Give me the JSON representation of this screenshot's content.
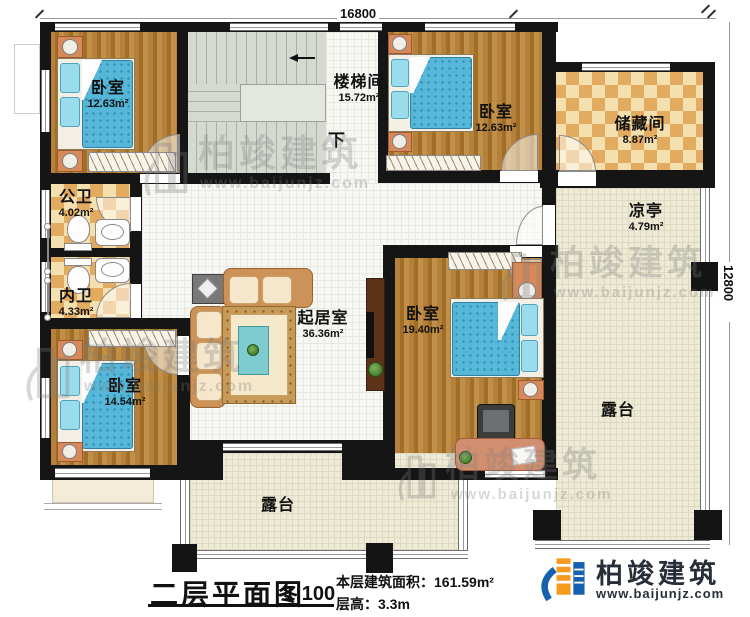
{
  "plan": {
    "title": "二层平面图",
    "scale": "1:100",
    "floor_area_label": "本层建筑面积：161.59m²",
    "floor_height_label": "层高：3.3m",
    "stairs_direction": "下",
    "dimensions": {
      "top": "16800",
      "right": "12800"
    }
  },
  "rooms": [
    {
      "id": "bedroom-top-left",
      "name": "卧室",
      "area": "12.63m²"
    },
    {
      "id": "stairwell",
      "name": "楼梯间",
      "area": "15.72m²"
    },
    {
      "id": "bedroom-top-right",
      "name": "卧室",
      "area": "12.63m²"
    },
    {
      "id": "storage",
      "name": "储藏间",
      "area": "8.87m²"
    },
    {
      "id": "pavilion",
      "name": "凉亭",
      "area": "4.79m²"
    },
    {
      "id": "public-bathroom",
      "name": "公卫",
      "area": "4.02m²"
    },
    {
      "id": "private-bathroom",
      "name": "内卫",
      "area": "4.33m²"
    },
    {
      "id": "living-room",
      "name": "起居室",
      "area": "36.36m²"
    },
    {
      "id": "bedroom-right",
      "name": "卧室",
      "area": "19.40m²"
    },
    {
      "id": "bedroom-bottom-left",
      "name": "卧室",
      "area": "14.54m²"
    },
    {
      "id": "terrace-bottom",
      "name": "露台",
      "area": ""
    },
    {
      "id": "terrace-right",
      "name": "露台",
      "area": ""
    }
  ],
  "branding": {
    "logo_text": "柏竣建筑",
    "logo_url": "www.baijunjz.com"
  },
  "watermark": {
    "text": "柏竣建筑",
    "url": "www.baijunjz.com"
  },
  "colors": {
    "wall": "#151515",
    "wood": "#ab7830",
    "tile_light": "#f4dfae",
    "tile_dark": "#e2ab5f",
    "stair": "#d5dad1",
    "floor_white": "#f7f7f4",
    "floor_cream": "#edead5",
    "mattress": "#57b7d8",
    "sofa": "#cc9257",
    "brand_blue": "#1660b0",
    "brand_orange": "#f59b1e"
  }
}
